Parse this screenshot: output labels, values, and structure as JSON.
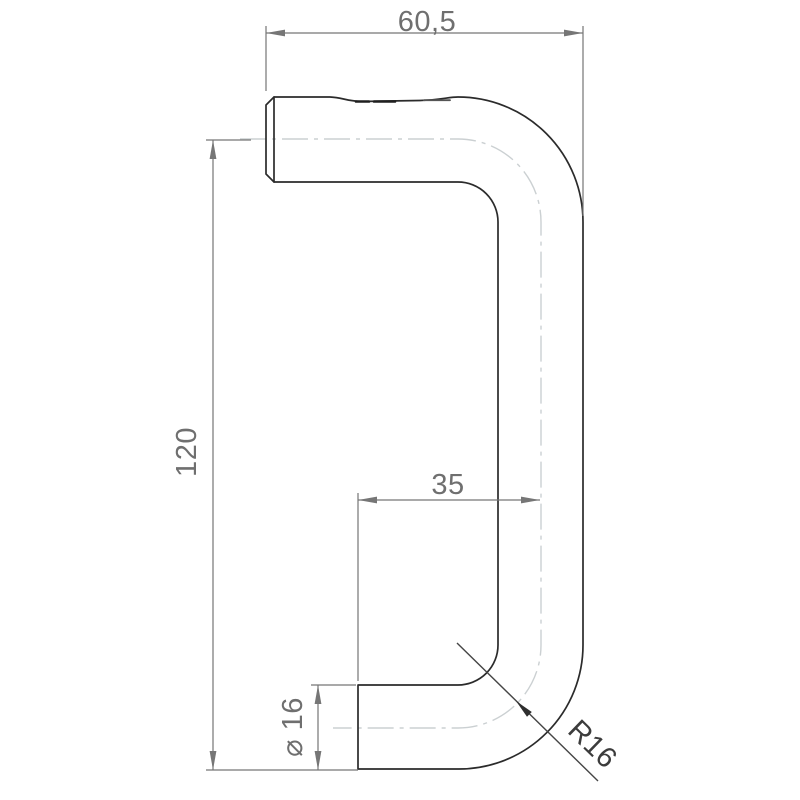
{
  "drawing": {
    "type": "technical-dimension-drawing",
    "subject": "bent tube pull handle, side profile",
    "labels": {
      "top_width": "60,5",
      "overall_height": "120",
      "center_offset": "35",
      "tube_diameter": "⌀ 16",
      "bend_radius": "R16"
    },
    "colors": {
      "background": "#ffffff",
      "outline": "#2b2b2b",
      "dimension_lines": "#767676",
      "dimension_text": "#6f6f6f",
      "centerline": "#cbd0d2",
      "leader": "#454545"
    }
  }
}
